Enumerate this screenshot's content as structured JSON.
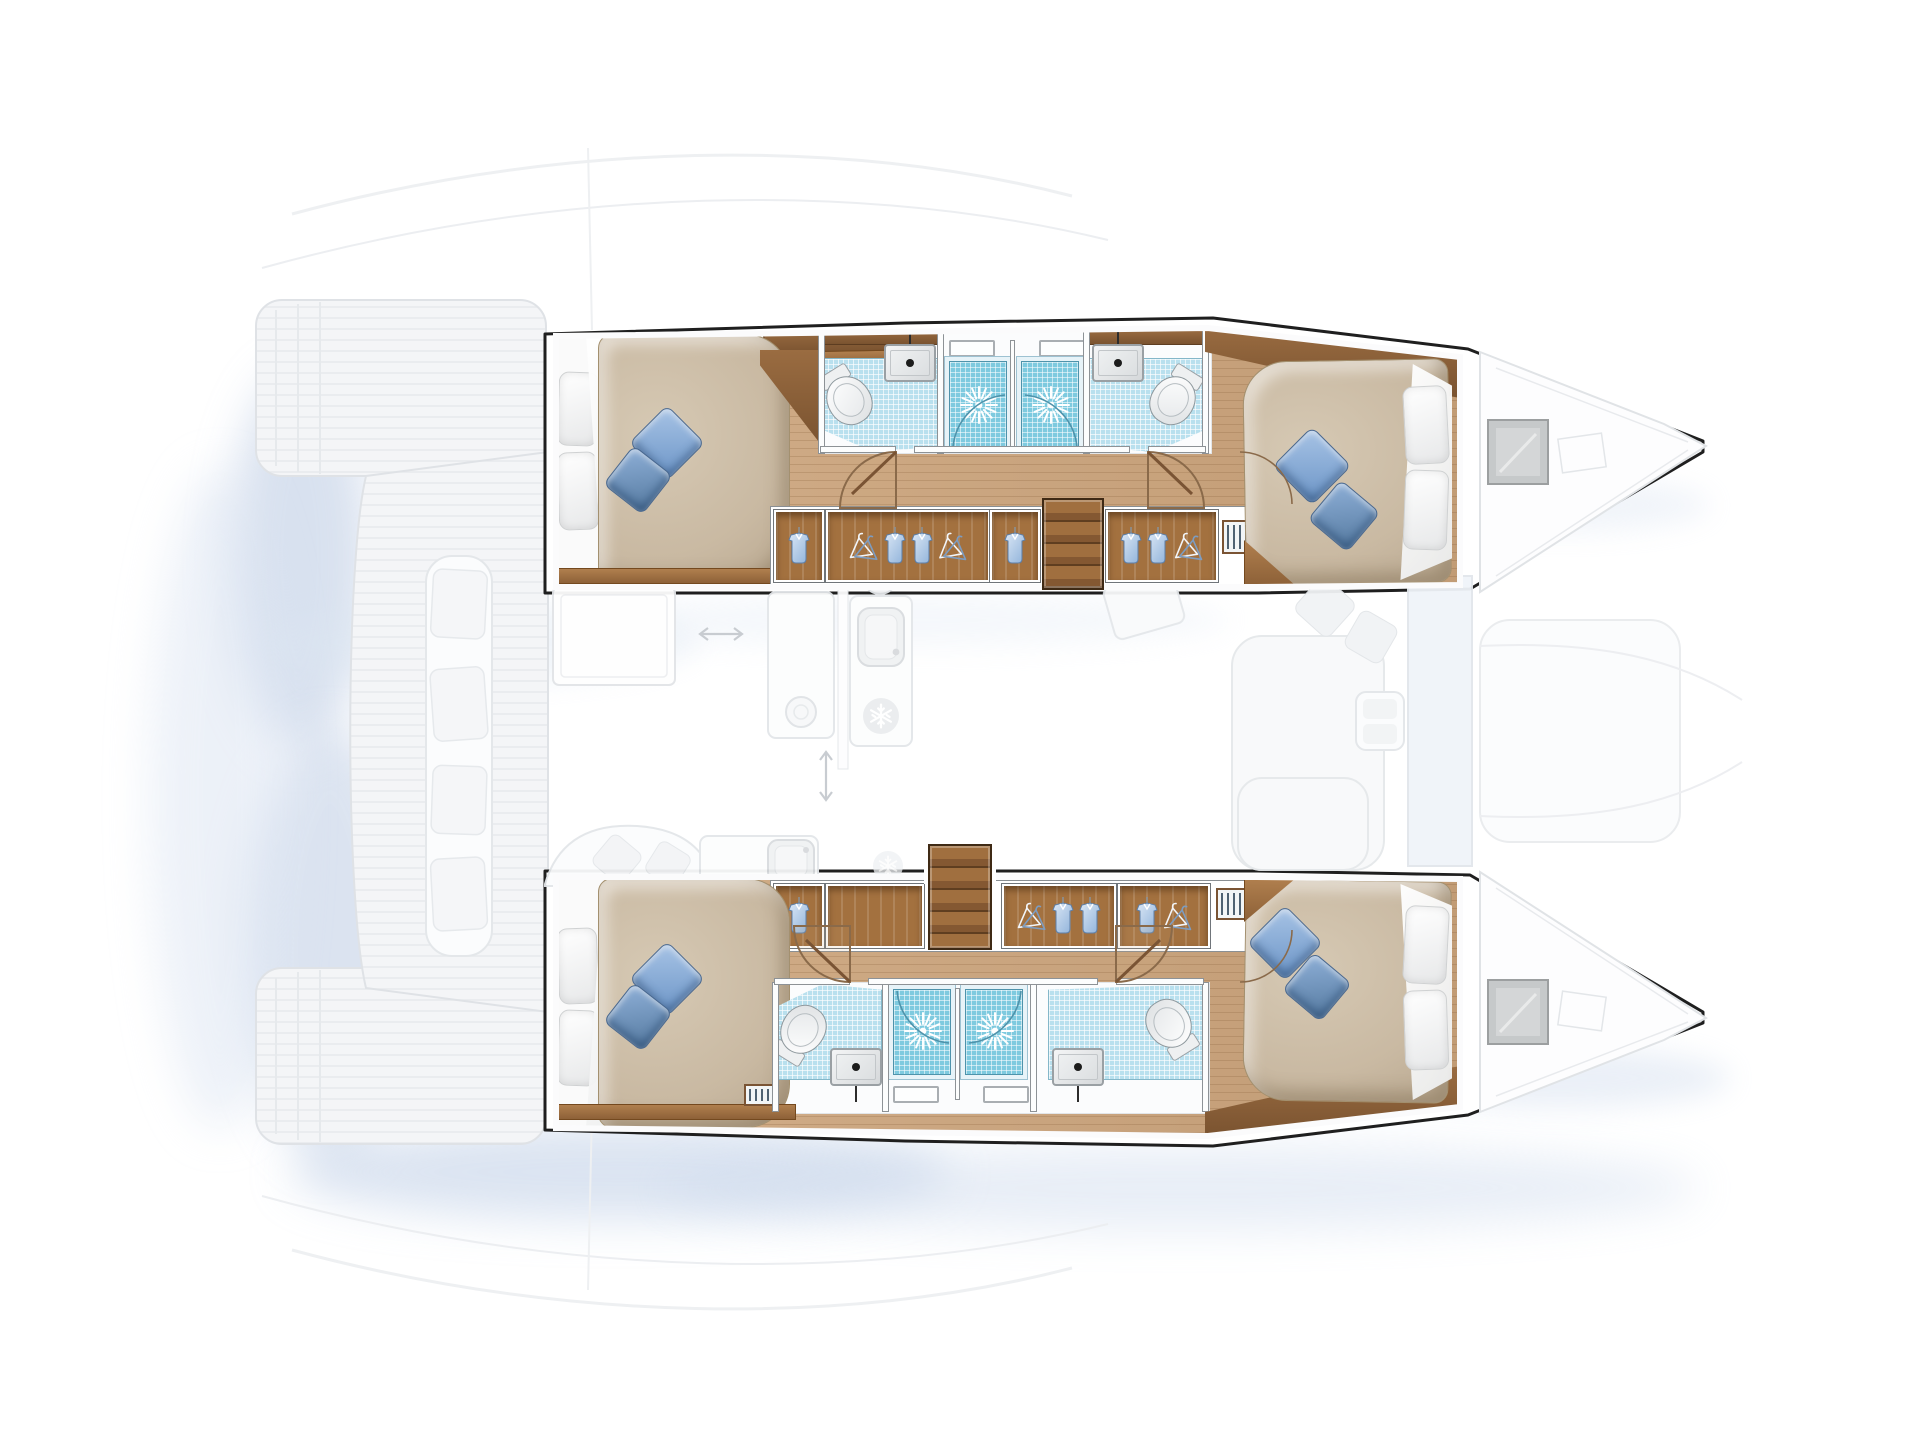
{
  "diagram": {
    "label": "Catamaran yacht floor plan (top view): four double cabins, four bathrooms with shower stalls in the two hulls; saloon, galley, cockpit and foredeck shown ghosted on the main deck",
    "render_style": "colour interiors inside hulls, pale ghosted deck furniture, soft blue drop shadows"
  },
  "palette": {
    "wood": "#cda57c",
    "dark_wood": "#7a5330",
    "cabinet_wood": "#a3713f",
    "tile": "#b9e0ee",
    "shower": "#7ecadf",
    "duvet": "#c9b9a2",
    "pillow_blue": "#6b94c6",
    "outline": "#1f1f1f",
    "ghost_line": "#e0e3e6",
    "ghost_fill": "#f4f5f7",
    "shadow_blue": "#c3d2e8"
  },
  "fixtures": {
    "berth": "Double berth with duvet, white pillows and blue cushions",
    "toilet": "Marine toilet",
    "basin": "Washbasin with faucet",
    "shower": "Shower stall with shower rose",
    "mirror": "Mirror / window panel",
    "wardrobe": "Hanging locker with hangers and shirts",
    "shirt_locker": "Hanging locker with shirt",
    "cabinet": "Stowage cabinet",
    "steps": "Companionway steps down into hull",
    "vent": "Louvred vent",
    "hatch": "Bow deck hatch",
    "door": "Cabin door swing",
    "tile_floor": "Tiled wet-room floor"
  },
  "hulls": {
    "upper": {
      "label": "Upper hull: aft double cabin, two bathrooms with central shower stalls, forward double cabin",
      "rooms": [
        "aft double cabin",
        "aft bathroom",
        "shower stalls",
        "forward bathroom",
        "forward double cabin"
      ]
    },
    "lower": {
      "label": "Lower hull: aft double cabin, two bathrooms with central shower stalls, forward double cabin",
      "rooms": [
        "aft double cabin",
        "aft bathroom",
        "shower stalls",
        "forward bathroom",
        "forward double cabin"
      ]
    }
  },
  "main_deck": {
    "aft_platform": "Transom platforms with steps",
    "cockpit_bench": "Aft cockpit bench with cushions",
    "cockpit_table": "Cockpit table",
    "galley": {
      "sink": "Galley sink",
      "stove": "Stove burner",
      "fridge": "Refrigerator (snowflake)",
      "dinnerware": "Plate with cutlery",
      "sliding_door": "Sliding-door travel arrows"
    },
    "saloon_seating": "Saloon sofa with cushions and side table",
    "forward_cockpit": "Forward cockpit lounge",
    "bow": "Bow decks with hatches",
    "coachroof": "Coachroof outline"
  },
  "counts": {
    "cabins": 4,
    "double_berths": 4,
    "bathrooms": 4,
    "shower_stalls": 4,
    "toilets": 4,
    "washbasins": 4,
    "hanging_lockers": 7,
    "companionways": 2,
    "deck_hatches": 2,
    "louvred_vents": 4
  }
}
